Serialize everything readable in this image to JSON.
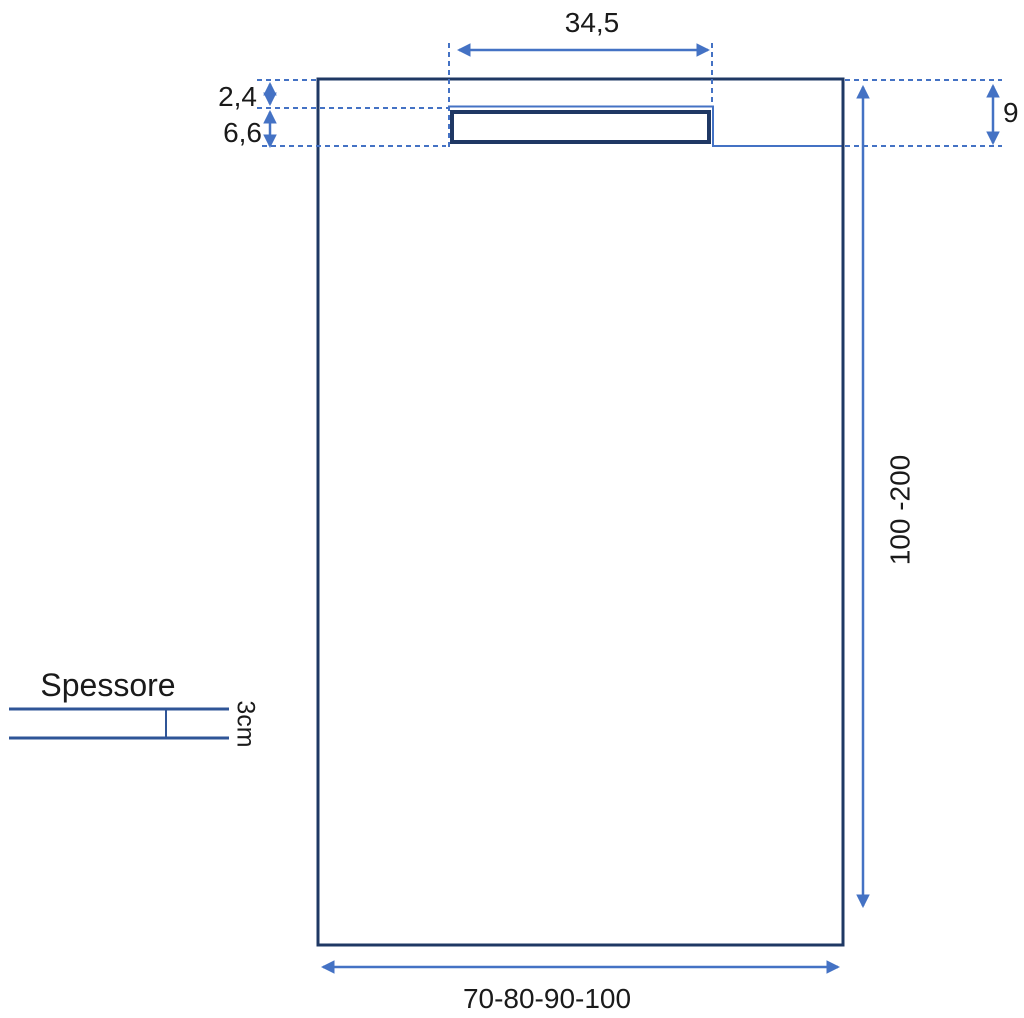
{
  "labels": {
    "drain_width": "34,5",
    "top_edge_offset": "2,4",
    "drain_slot_height": "6,6",
    "drain_zone_depth": "9",
    "length_range": "100 -200",
    "width_options": "70-80-90-100",
    "thickness_title": "Spessore",
    "thickness_value": "3cm"
  },
  "colors": {
    "outline_dark_navy": "#1f3864",
    "accent_blue": "#4472c4",
    "mid_blue": "#2f5597",
    "text": "#1a1a1a",
    "background": "#ffffff"
  }
}
